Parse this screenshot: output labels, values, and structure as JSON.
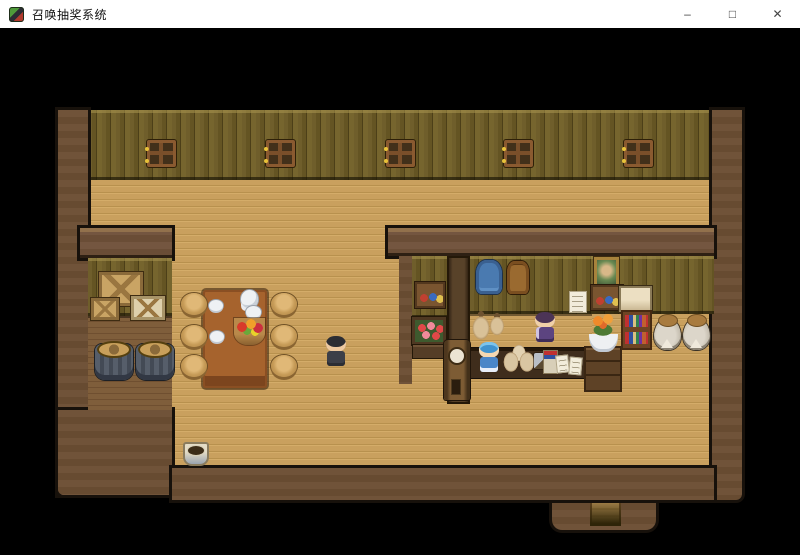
{
  "window": {
    "title": "召唤抽奖系统",
    "controls": {
      "minimize": "–",
      "maximize": "□",
      "close": "✕"
    }
  },
  "scene": {
    "map": "tavern-interior",
    "entities": {
      "player": "hero in dark clothes standing mid-room",
      "shopkeeper": "purple-haired clerk behind counter",
      "patron": "blue-haired girl at counter front"
    },
    "palette": {
      "titlebar_bg": "#ffffff",
      "background": "#000000",
      "wall_olive": "#6f5e2b",
      "floor_tan": "#c9a05e",
      "wall_border_brown": "#705339",
      "alcove_floor": "#7f5e3b",
      "table_wood": "#a6632d",
      "counter_front": "#3f2d1c",
      "accent_gold": "#e8c23a"
    }
  }
}
